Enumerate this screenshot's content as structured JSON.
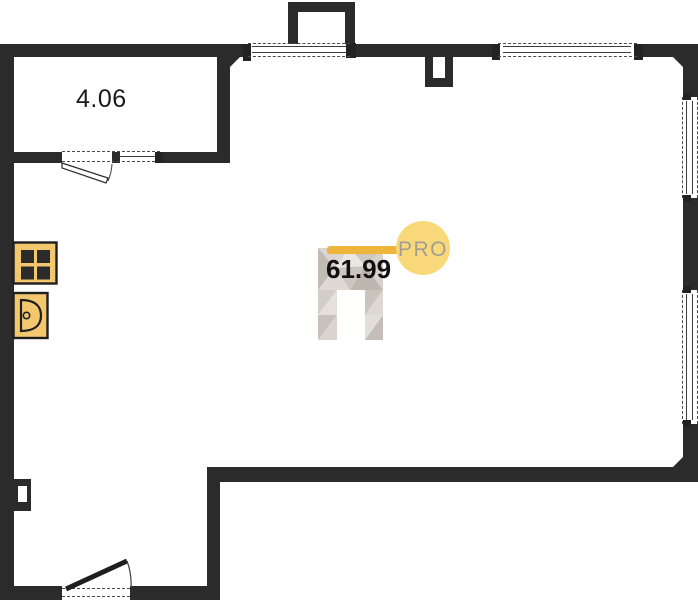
{
  "plan": {
    "type": "floor-plan",
    "rooms": [
      {
        "name": "small-room",
        "area_label": "4.06"
      },
      {
        "name": "main-space",
        "area_label": "61.99"
      }
    ],
    "watermark": {
      "text": "PRO"
    },
    "fixtures": [
      {
        "icon": "stove-icon"
      },
      {
        "icon": "sink-icon"
      }
    ],
    "colors": {
      "wall": "#2b2b2b",
      "floor": "#ffffff",
      "fixture_fill": "#f3c76e",
      "watermark_bar": "#efb53b",
      "watermark_circle": "#f9d87a",
      "watermark_text": "#a29d94"
    }
  }
}
